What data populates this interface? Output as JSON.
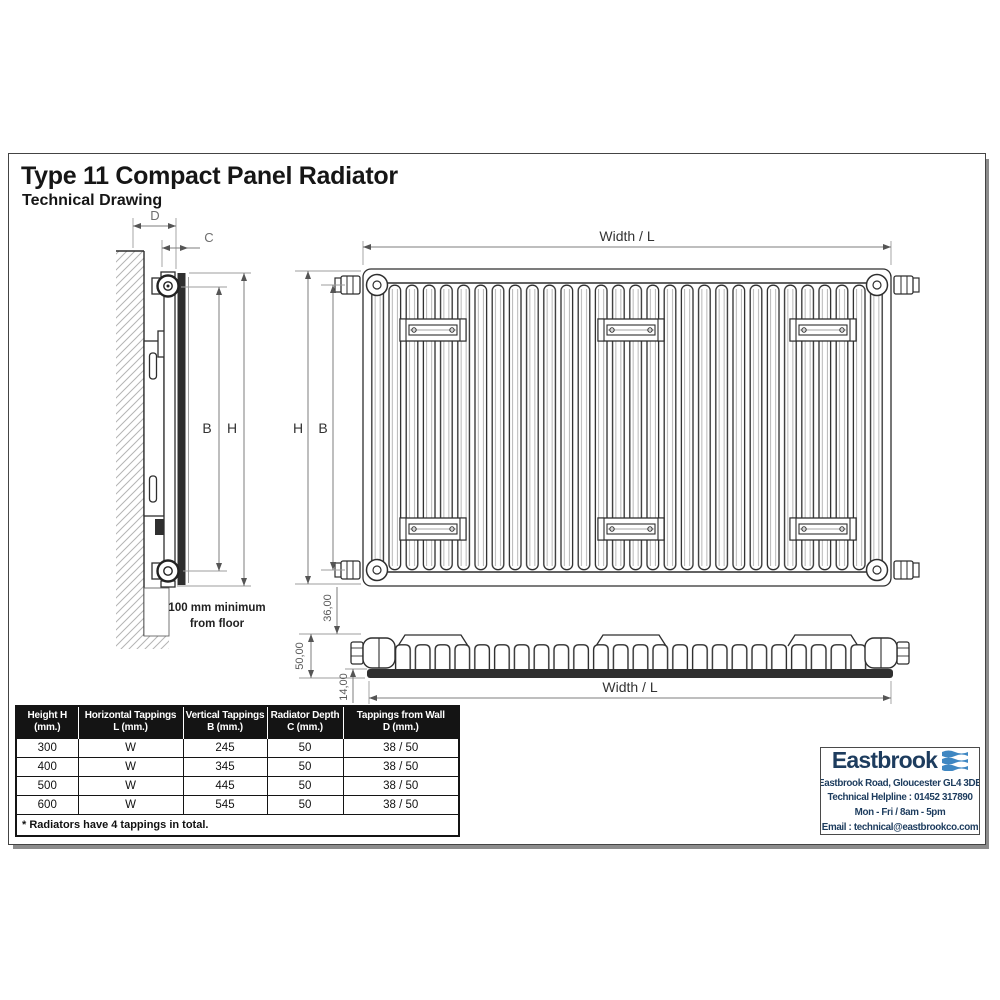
{
  "page": {
    "title": "Type 11 Compact Panel Radiator",
    "subtitle": "Technical Drawing"
  },
  "side_view": {
    "dim_d": "D",
    "dim_c": "C",
    "dim_b": "B",
    "dim_h": "H",
    "floor_note": [
      "100 mm minimum",
      "from floor"
    ]
  },
  "front_view": {
    "dim_width": "Width / L",
    "dim_h": "H",
    "dim_b": "B"
  },
  "top_view": {
    "dim_bracket": "36,00",
    "dim_depth": "50,00",
    "dim_panel": "14,00",
    "dim_width": "Width / L"
  },
  "spec_table": {
    "headers": [
      {
        "l1": "Height H",
        "l2": "(mm.)"
      },
      {
        "l1": "Horizontal Tappings",
        "l2": "L (mm.)"
      },
      {
        "l1": "Vertical Tappings",
        "l2": "B (mm.)"
      },
      {
        "l1": "Radiator Depth",
        "l2": "C (mm.)"
      },
      {
        "l1": "Tappings from Wall",
        "l2": "D (mm.)"
      }
    ],
    "rows": [
      [
        "300",
        "W",
        "245",
        "50",
        "38 / 50"
      ],
      [
        "400",
        "W",
        "345",
        "50",
        "38 / 50"
      ],
      [
        "500",
        "W",
        "445",
        "50",
        "38 / 50"
      ],
      [
        "600",
        "W",
        "545",
        "50",
        "38 / 50"
      ]
    ],
    "footnote": "* Radiators have 4 tappings in total."
  },
  "company": {
    "name": "Eastbrook",
    "address": "Eastbrook Road, Gloucester GL4 3DB",
    "helpline": "Technical Helpline : 01452 317890",
    "hours": "Mon - Fri / 8am - 5pm",
    "email": "Email : technical@eastbrookco.com",
    "brand_navy": "#1d3c5e",
    "brand_blue": "#3f87c2"
  }
}
